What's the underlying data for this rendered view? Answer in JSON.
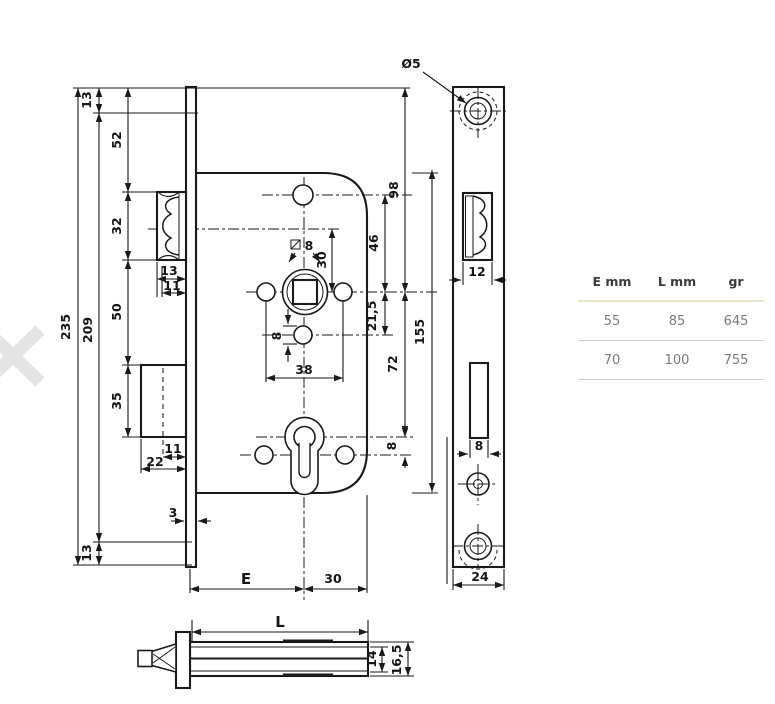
{
  "table": {
    "headers": [
      "E mm",
      "L mm",
      "gr"
    ],
    "rows": [
      [
        "55",
        "85",
        "645"
      ],
      [
        "70",
        "100",
        "755"
      ]
    ]
  },
  "dims": {
    "h235": "235",
    "h209": "209",
    "t13": "13",
    "b13": "13",
    "s52": "52",
    "s32": "32",
    "s50": "50",
    "s35": "35",
    "w13": "13",
    "w11": "11",
    "b11": "11",
    "b22": "22",
    "t3": "3",
    "E": "E",
    "b30": "30",
    "sq8": "8",
    "v30": "30",
    "hole8": "8",
    "w38": "38",
    "v46": "46",
    "v98": "98",
    "v215": "21,5",
    "v72": "72",
    "v155": "155",
    "v8": "8",
    "dia5": "Ø5",
    "f12": "12",
    "f8": "8",
    "f24": "24",
    "L": "L",
    "v14": "14",
    "v165": "16,5"
  },
  "colors": {
    "line": "#1a1a1a",
    "table_header_rule": "#e9e5cc",
    "table_rule": "#cfcfcf"
  }
}
